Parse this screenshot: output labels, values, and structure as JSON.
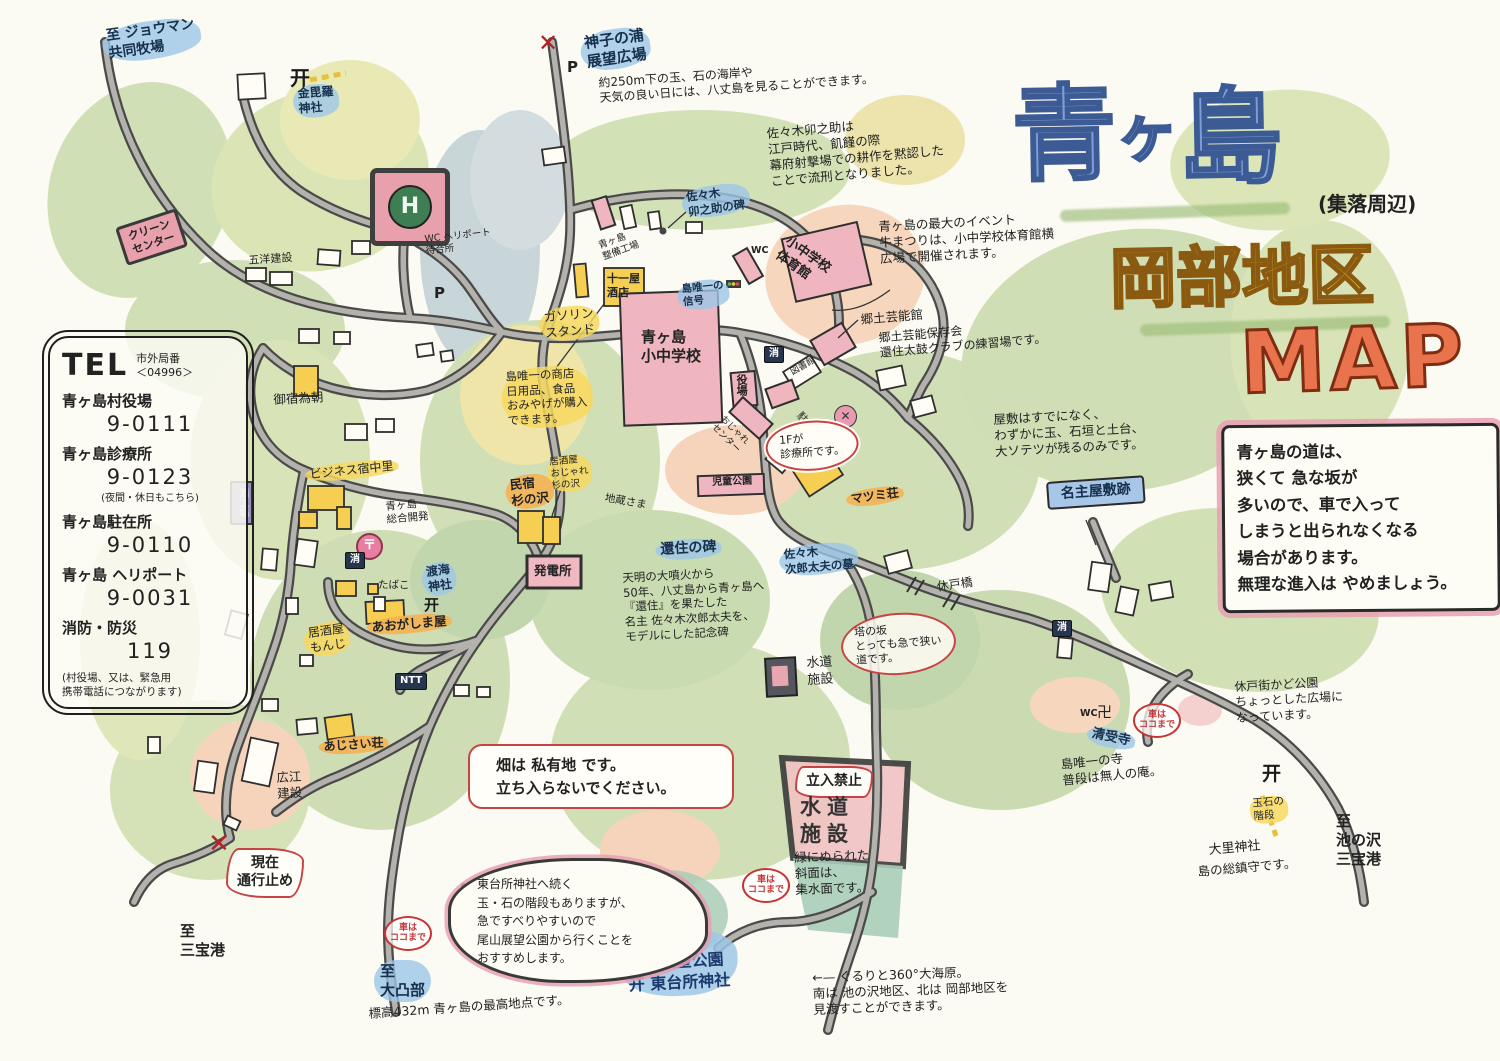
{
  "title": {
    "main_1": "青",
    "main_2": "ヶ",
    "main_3": "島",
    "sub": "(集落周辺)",
    "district_a": "岡部",
    "district_b": "地区",
    "map_word": "MAP",
    "accent_blue": "#7b9fd4",
    "accent_orange": "#f0a13c",
    "accent_red": "#e8734c"
  },
  "tel": {
    "heading": "TEL",
    "area_label": "市外局番\n＜04996＞",
    "entries": [
      {
        "name": "青ヶ島村役場",
        "num": "9-0111",
        "sub": ""
      },
      {
        "name": "青ヶ島診療所",
        "num": "9-0123",
        "sub": "(夜間・休日もこちら)"
      },
      {
        "name": "青ヶ島駐在所",
        "num": "9-0110",
        "sub": ""
      },
      {
        "name": "青ヶ島 ヘリポート",
        "num": "9-0031",
        "sub": ""
      },
      {
        "name": "消防・防災",
        "num": "119",
        "sub": ""
      }
    ],
    "footer": "(村役場、又は、緊急用\n携帯電話につながります)"
  },
  "notes": {
    "road_warning": "青ヶ島の道は、\n狭くて 急な坂が\n多いので、車で入って\nしまうと出られなくなる\n場合があります。\n無理な進入は やめましょう。",
    "hatake": "畑は 私有地 です。\n立ち入らないでください。",
    "todaisho_bubble": "東台所神社へ続く\n玉・石の階段もありますが、\n急ですべりやすいので\n尾山展望公園から行くことを\nおすすめします。"
  },
  "map_items": [
    {
      "n": "dest-joman",
      "t": "至 ジョウマン\n共同牧場",
      "x": 100,
      "y": 28,
      "c": "blue",
      "r": -8,
      "s": 14
    },
    {
      "n": "torii-kompira-icon",
      "t": "开",
      "x": 290,
      "y": 66,
      "c": "torii",
      "s": 20
    },
    {
      "n": "label-kompira-jinja",
      "t": "金毘羅\n神社",
      "x": 292,
      "y": 86,
      "c": "blue",
      "r": -4,
      "s": 12
    },
    {
      "n": "label-clean-center",
      "t": "クリーン\nセンター",
      "x": 115,
      "y": 228,
      "c": "pinkbox",
      "r": -18,
      "s": 11
    },
    {
      "n": "label-goyo-kensetsu",
      "t": "五洋建設",
      "x": 248,
      "y": 254,
      "c": "lbl",
      "r": -4,
      "s": 11
    },
    {
      "n": "heliport-mark",
      "t": "",
      "x": 370,
      "y": 168,
      "c": "heli",
      "s": 0
    },
    {
      "n": "label-wc-heliport",
      "t": "WC ヘリポート\n待合所",
      "x": 424,
      "y": 234,
      "c": "lbl",
      "r": -6,
      "s": 9.5
    },
    {
      "n": "p-mark-heliport",
      "t": "P",
      "x": 434,
      "y": 284,
      "c": "pmark",
      "s": 15
    },
    {
      "n": "x-mark-mikonoura",
      "t": "✕",
      "x": 538,
      "y": 28,
      "c": "redx",
      "s": 24
    },
    {
      "n": "p-mark-mikonoura",
      "t": "P",
      "x": 567,
      "y": 58,
      "c": "pmark",
      "s": 15
    },
    {
      "n": "dest-mikonoura",
      "t": "神子の浦\n展望広場",
      "x": 578,
      "y": 34,
      "c": "blue",
      "r": -8,
      "s": 15
    },
    {
      "n": "note-mikonoura",
      "t": "約250m下の玉、石の海岸や\n天気の良い日には、八丈島を見ることができます。",
      "x": 598,
      "y": 76,
      "c": "note",
      "r": -4,
      "s": 12
    },
    {
      "n": "note-unosuke",
      "t": "佐々木卯之助は\n江戸時代、飢饉の際\n幕府射撃場での耕作を黙認した\nことで流刑となりました。",
      "x": 766,
      "y": 126,
      "c": "note",
      "r": -5,
      "s": 12.5
    },
    {
      "n": "label-unosuke-hi",
      "t": "佐々木\n卯之助の碑",
      "x": 680,
      "y": 190,
      "c": "blue",
      "r": -8,
      "s": 11.5
    },
    {
      "n": "label-seibi-kojo",
      "t": "青ヶ島\n整備工場",
      "x": 597,
      "y": 241,
      "c": "lbl",
      "r": -20,
      "s": 9.5
    },
    {
      "n": "label-juichiya",
      "t": "十一屋\n酒店",
      "x": 607,
      "y": 272,
      "c": "bld",
      "s": 11
    },
    {
      "n": "label-gasoline-stand",
      "t": "ガソリン\nスタンド",
      "x": 538,
      "y": 309,
      "c": "yellow",
      "r": -5,
      "s": 12.5
    },
    {
      "n": "label-shingo",
      "t": "島唯一の\n信号",
      "x": 676,
      "y": 283,
      "c": "blue",
      "r": -6,
      "s": 10.5
    },
    {
      "n": "label-school",
      "t": "青ヶ島\n小中学校",
      "x": 641,
      "y": 328,
      "c": "bld",
      "s": 15
    },
    {
      "n": "note-shoten",
      "t": "島唯一の商店\n日用品、食品\nおみやげが購入\nできます。",
      "x": 500,
      "y": 369,
      "c": "yellow",
      "r": -3,
      "s": 11.5
    },
    {
      "n": "label-wc-gym",
      "t": "WC",
      "x": 751,
      "y": 245,
      "c": "wc",
      "s": 9.5
    },
    {
      "n": "label-gym",
      "t": "小中学校\n体育館",
      "x": 791,
      "y": 234,
      "c": "bld",
      "r": 35,
      "s": 13
    },
    {
      "n": "note-ushimatsuri",
      "t": "青ヶ島の最大のイベント\n牛まつりは、小中学校体育館横\n広場で開催されます。",
      "x": 878,
      "y": 219,
      "c": "note",
      "r": -3,
      "s": 12.5
    },
    {
      "n": "label-geinokan",
      "t": "郷土芸能館",
      "x": 860,
      "y": 312,
      "c": "lbl-md",
      "r": -5,
      "s": 12.5
    },
    {
      "n": "note-geinokan",
      "t": "郷土芸能保存会\n還住太鼓クラブの練習場です。",
      "x": 878,
      "y": 331,
      "c": "note",
      "r": -5,
      "s": 12
    },
    {
      "n": "label-yakuba",
      "t": "役場",
      "x": 734,
      "y": 374,
      "c": "bldv",
      "s": 11
    },
    {
      "n": "badge-shobo-1",
      "t": "消",
      "x": 764,
      "y": 346,
      "c": "navy",
      "s": 10
    },
    {
      "n": "label-toshokan",
      "t": "図書館",
      "x": 789,
      "y": 369,
      "c": "lbl",
      "r": -30,
      "s": 9
    },
    {
      "n": "badge-chuzaisho-x",
      "t": "✕",
      "x": 834,
      "y": 405,
      "c": "xcircle",
      "s": 12
    },
    {
      "n": "label-chuzaisho",
      "t": "駐在所",
      "x": 803,
      "y": 410,
      "c": "lbl",
      "r": 48,
      "s": 10.5
    },
    {
      "n": "cloud-shinryojo",
      "t": "1Fが\n診療所です。",
      "x": 764,
      "y": 424,
      "c": "cloud",
      "r": -4,
      "s": 11
    },
    {
      "n": "label-ojare-center",
      "t": "おじゃれ\nセンター",
      "x": 725,
      "y": 414,
      "c": "lbl",
      "r": 45,
      "s": 9
    },
    {
      "n": "label-jido-koen",
      "t": "児童公園",
      "x": 712,
      "y": 477,
      "c": "bld",
      "r": -2,
      "s": 10
    },
    {
      "n": "label-matsumi-so",
      "t": "マツミ荘",
      "x": 845,
      "y": 492,
      "c": "orange",
      "r": -8,
      "s": 12
    },
    {
      "n": "note-nanushi-yashiki",
      "t": "屋敷はすでになく、\nわずかに玉、石垣と土台、\n大ソテツが残るのみです。",
      "x": 993,
      "y": 412,
      "c": "note",
      "r": -3,
      "s": 12.5
    },
    {
      "n": "sign-nanushi-yashiki",
      "t": "名主屋敷跡",
      "x": 1046,
      "y": 482,
      "c": "bluesign",
      "r": -4,
      "s": 14
    },
    {
      "n": "label-oyado-tametomo",
      "t": "御宿為朝",
      "x": 273,
      "y": 392,
      "c": "lbl-md",
      "r": -3,
      "s": 12.5
    },
    {
      "n": "label-yado-nakazato",
      "t": "ビジネス宿中里",
      "x": 304,
      "y": 467,
      "c": "yellow",
      "r": -6,
      "s": 12
    },
    {
      "n": "label-sogo-kaihatsu",
      "t": "青ヶ島\n総合開発",
      "x": 385,
      "y": 501,
      "c": "lbl",
      "r": -5,
      "s": 10.5
    },
    {
      "n": "badge-post-office",
      "t": "〒",
      "x": 356,
      "y": 533,
      "c": "post",
      "s": 13
    },
    {
      "n": "badge-shobo-2",
      "t": "消",
      "x": 345,
      "y": 552,
      "c": "navy",
      "s": 10
    },
    {
      "n": "label-tabako",
      "t": "たばこ",
      "x": 378,
      "y": 579,
      "c": "lbl",
      "s": 10.5
    },
    {
      "n": "label-tokai-jinja",
      "t": "渡海\n神社",
      "x": 420,
      "y": 565,
      "c": "blue",
      "r": -8,
      "s": 12
    },
    {
      "n": "torii-tokai-icon",
      "t": "开",
      "x": 424,
      "y": 596,
      "c": "torii",
      "s": 15
    },
    {
      "n": "label-sake-kojo",
      "t": "酒工場",
      "x": 230,
      "y": 481,
      "c": "purplebox",
      "s": 10
    },
    {
      "n": "label-jizo-sama",
      "t": "地蔵さま",
      "x": 606,
      "y": 492,
      "c": "lbl",
      "r": 10,
      "s": 10.5
    },
    {
      "n": "label-izakaya-suginosawa",
      "t": "居酒屋\nおじゃれ\n杉の沢",
      "x": 546,
      "y": 457,
      "c": "yellow-sm",
      "r": -5,
      "s": 9.5
    },
    {
      "n": "label-minshuku-suginosawa",
      "t": "民宿\n杉の沢",
      "x": 504,
      "y": 477,
      "c": "orange",
      "r": -6,
      "s": 12.5
    },
    {
      "n": "label-hatsudensho",
      "t": "発電所",
      "x": 534,
      "y": 563,
      "c": "bld",
      "s": 12.5
    },
    {
      "n": "label-aogashimaya",
      "t": "あおがしま屋",
      "x": 366,
      "y": 619,
      "c": "orange",
      "r": -5,
      "s": 12.5
    },
    {
      "n": "label-izakaya-monji",
      "t": "居酒屋\nもんじ",
      "x": 302,
      "y": 626,
      "c": "yellow",
      "r": -8,
      "s": 12
    },
    {
      "n": "badge-ntt",
      "t": "NTT",
      "x": 395,
      "y": 673,
      "c": "navy",
      "s": 10
    },
    {
      "n": "label-ajisai-so",
      "t": "あじさい荘",
      "x": 318,
      "y": 739,
      "c": "orange",
      "r": -4,
      "s": 12
    },
    {
      "n": "label-hiroe-kensetsu",
      "t": "広江\n建設",
      "x": 276,
      "y": 770,
      "c": "lbl-md",
      "r": -3,
      "s": 12.5
    },
    {
      "n": "label-kanju-no-hi",
      "t": "還住の碑",
      "x": 655,
      "y": 541,
      "c": "blue",
      "r": -3,
      "s": 14
    },
    {
      "n": "note-kanju",
      "t": "天明の大噴火から\n50年、八丈島から青ヶ島へ\n『還住』を果たした\n名主 佐々木次郎太夫を、\nモデルにした記念碑",
      "x": 622,
      "y": 571,
      "c": "note",
      "r": -3,
      "s": 11.5
    },
    {
      "n": "label-jirodayu-haka",
      "t": "佐々木\n次郎太夫の墓",
      "x": 778,
      "y": 547,
      "c": "blue",
      "r": -5,
      "s": 11.5
    },
    {
      "n": "oval-tonosaka",
      "t": "塔の坂\nとっても急で狭い\n道です。",
      "x": 839,
      "y": 617,
      "c": "redoval",
      "r": -4,
      "s": 11
    },
    {
      "n": "label-suido-shisetsu-small",
      "t": "水道\n施設",
      "x": 806,
      "y": 656,
      "c": "lbl-md",
      "r": -3,
      "s": 13
    },
    {
      "n": "label-yasundo-bashi",
      "t": "休戸橋",
      "x": 936,
      "y": 580,
      "c": "lbl-md",
      "r": -8,
      "s": 12
    },
    {
      "n": "badge-shobo-3",
      "t": "消",
      "x": 1052,
      "y": 620,
      "c": "navy",
      "s": 10
    },
    {
      "n": "note-kado-koen",
      "t": "休戸街かど公園\nちょっとした広場に\nなっています。",
      "x": 1234,
      "y": 680,
      "c": "note",
      "r": -3,
      "s": 12
    },
    {
      "n": "label-wc-seijuji",
      "t": "WC",
      "x": 1080,
      "y": 708,
      "c": "wc",
      "s": 9.5
    },
    {
      "n": "label-manji",
      "t": "卍",
      "x": 1097,
      "y": 703,
      "c": "lbl-md",
      "s": 15
    },
    {
      "n": "label-seijuji",
      "t": "清受寺",
      "x": 1089,
      "y": 724,
      "c": "blue",
      "r": 12,
      "s": 13
    },
    {
      "n": "circle-kuruma-1",
      "t": "車は\nココまで",
      "x": 1133,
      "y": 703,
      "c": "redcircle",
      "s": 9
    },
    {
      "n": "note-seijuji",
      "t": "島唯一の寺\n普段は無人の庵。",
      "x": 1060,
      "y": 757,
      "c": "note",
      "r": -6,
      "s": 12.5
    },
    {
      "n": "torii-osato-icon",
      "t": "开",
      "x": 1262,
      "y": 762,
      "c": "torii",
      "s": 19
    },
    {
      "n": "label-tamaishi-kaidan",
      "t": "玉石の\n階段",
      "x": 1249,
      "y": 798,
      "c": "yellow-sm",
      "r": -5,
      "s": 10.5
    },
    {
      "n": "label-osato-jinja",
      "t": "大里神社",
      "x": 1208,
      "y": 843,
      "c": "lbl-md",
      "r": -5,
      "s": 13
    },
    {
      "n": "note-osato-jinja",
      "t": "島の総鎮守です。",
      "x": 1197,
      "y": 864,
      "c": "note",
      "r": -5,
      "s": 12.5
    },
    {
      "n": "dest-ikenosawa-sanpoko",
      "t": "至\n池の沢\n三宝港",
      "x": 1336,
      "y": 812,
      "c": "dest",
      "s": 15
    },
    {
      "n": "x-mark-tsukodome",
      "t": "✕",
      "x": 208,
      "y": 828,
      "c": "redx",
      "s": 26
    },
    {
      "n": "burst-tsukodome",
      "t": "現在\n通行止め",
      "x": 226,
      "y": 848,
      "c": "burst",
      "s": 14
    },
    {
      "n": "dest-sanpoko",
      "t": "至\n三宝港",
      "x": 180,
      "y": 922,
      "c": "dest",
      "s": 15
    },
    {
      "n": "circle-kuruma-2",
      "t": "車は\nココまで",
      "x": 384,
      "y": 916,
      "c": "redcircle",
      "s": 9
    },
    {
      "n": "dest-otonbu",
      "t": "至\n大凸部",
      "x": 374,
      "y": 960,
      "c": "dest-blue",
      "s": 15
    },
    {
      "n": "note-otonbu",
      "t": "標高432m 青ヶ島の最高地点です。",
      "x": 368,
      "y": 1006,
      "c": "note",
      "r": -4,
      "s": 12.5
    },
    {
      "n": "excl-bubble",
      "t": "!",
      "x": 458,
      "y": 878,
      "c": "excl",
      "s": 24
    },
    {
      "n": "circle-kuruma-3",
      "t": "車は\nココまで",
      "x": 742,
      "y": 868,
      "c": "redcircle",
      "s": 9
    },
    {
      "n": "burst-tachiiri-kinshi",
      "t": "立入禁止",
      "x": 795,
      "y": 766,
      "c": "burst",
      "s": 14
    },
    {
      "n": "label-suido-shisetsu-big",
      "t": "水道\n施設",
      "x": 800,
      "y": 794,
      "c": "suido-big",
      "s": 21
    },
    {
      "n": "note-shusuimen",
      "t": "緑にぬられた\n斜面は、\n集水面です。",
      "x": 794,
      "y": 850,
      "c": "note",
      "r": -2,
      "s": 12.5
    },
    {
      "n": "dest-oyama-koen",
      "t": "至\n尾山展望公園\n开 東台所神社",
      "x": 618,
      "y": 932,
      "c": "bigblue",
      "r": -3,
      "s": 16
    },
    {
      "n": "note-360-view",
      "t": "←— ぐるりと360°大海原。\n南は 池の沢地区、北は 岡部地区を\n見渡すことができます。",
      "x": 812,
      "y": 970,
      "c": "note",
      "r": -2,
      "s": 12.5
    },
    {
      "n": "excl-hatake",
      "t": "!",
      "x": 478,
      "y": 750,
      "c": "excl",
      "s": 22
    },
    {
      "n": "excl-road-warning",
      "t": "!",
      "x": 1226,
      "y": 428,
      "c": "excl",
      "s": 26
    }
  ]
}
